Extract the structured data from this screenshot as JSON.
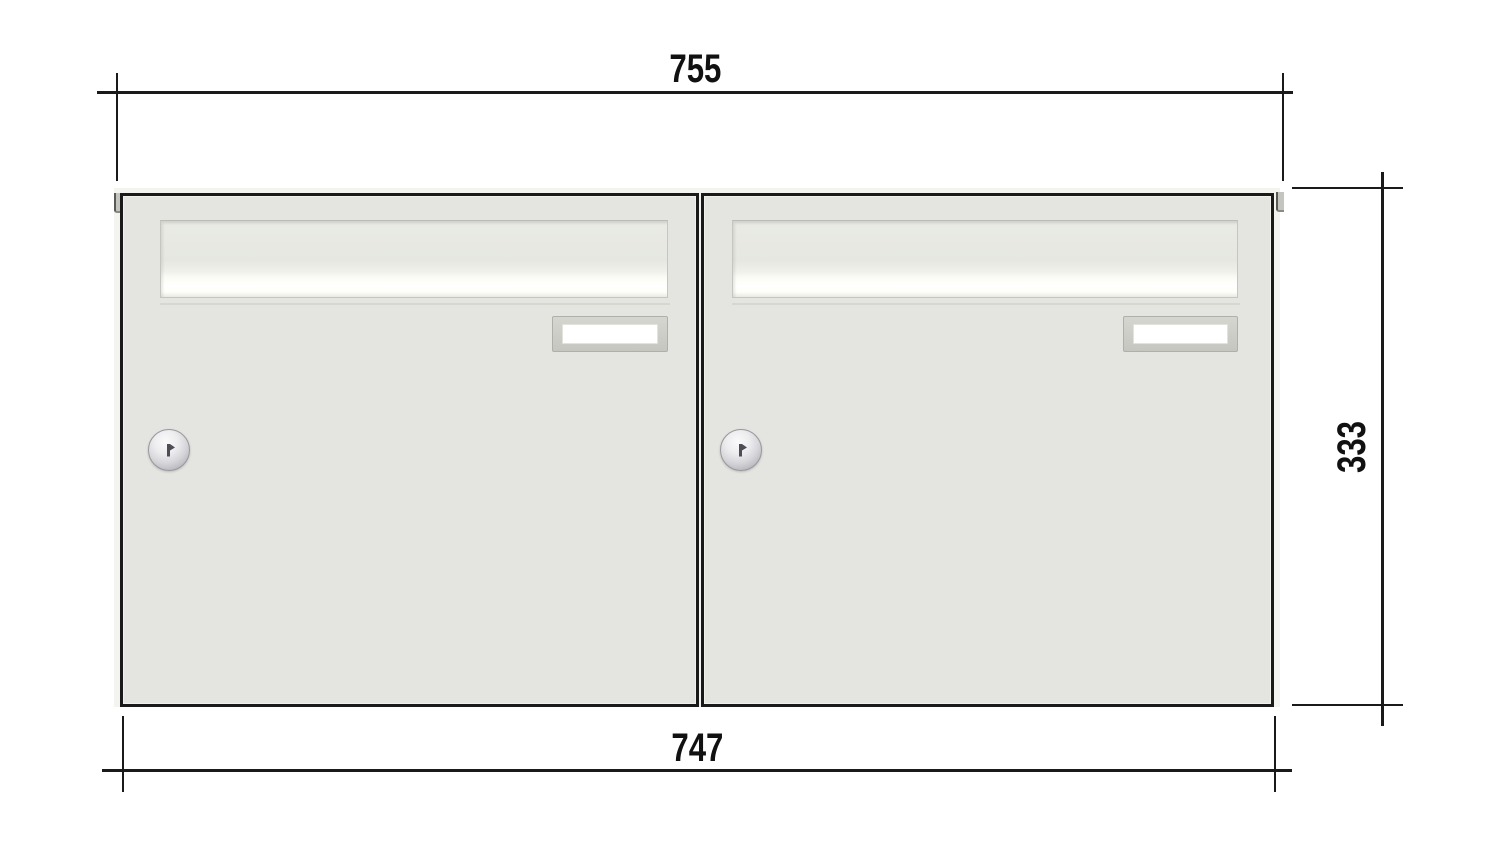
{
  "diagram": {
    "type": "technical-drawing",
    "subject": "wall-mounted letterbox unit with two boxes side by side, front view with outer dimensions",
    "dimensions": {
      "top_width": "755",
      "bottom_width": "747",
      "height": "333"
    },
    "unit": {
      "box_count": 2,
      "features_per_box": [
        "mail-flap",
        "name-plate",
        "cylinder-lock"
      ]
    },
    "colors": {
      "door_fill": "#e4e5e0",
      "door_outline": "#1a1a1a",
      "dimension_lines": "#1a1a1a",
      "flap_highlight": "#ffffff",
      "plate_frame": "#c9c9c3",
      "plate_window": "#ffffff",
      "lock_metal": "#c9c9cd",
      "background": "#ffffff"
    }
  }
}
